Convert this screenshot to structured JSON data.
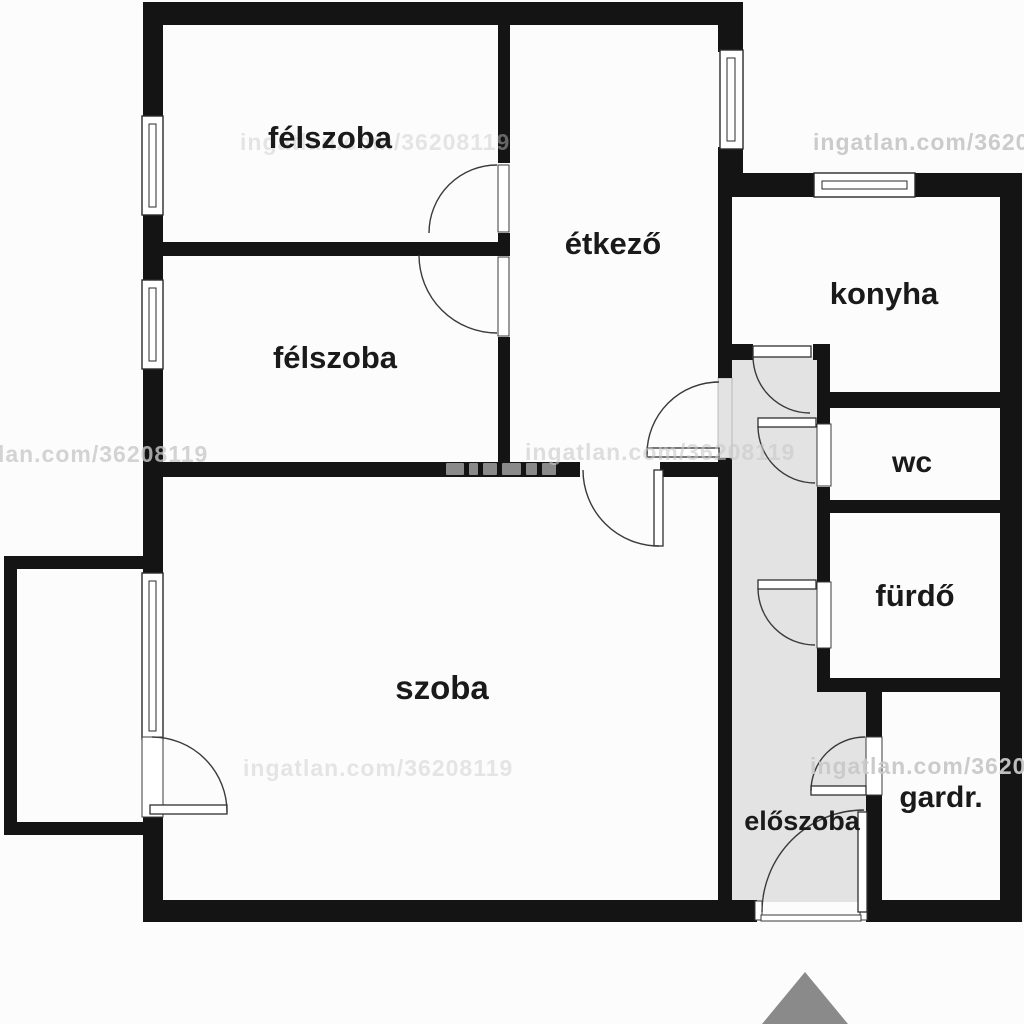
{
  "floorplan": {
    "rooms": {
      "felszoba1": {
        "label": "félszoba"
      },
      "felszoba2": {
        "label": "félszoba"
      },
      "etkezo": {
        "label": "étkező"
      },
      "konyha": {
        "label": "konyha"
      },
      "wc": {
        "label": "wc"
      },
      "furdo": {
        "label": "fürdő"
      },
      "szoba": {
        "label": "szoba"
      },
      "eloszoba": {
        "label": "előszoba"
      },
      "gardrob": {
        "label": "gardr."
      }
    },
    "watermark": {
      "text": "ingatlan.com/36208119"
    },
    "colors": {
      "wall": "#141414",
      "hallway_floor": "#e3e3e3",
      "label_text": "#1a1a1a",
      "watermark": "#c9c9c9",
      "entrance_arrow": "#8a8a8a",
      "background": "#fcfcfc"
    }
  }
}
